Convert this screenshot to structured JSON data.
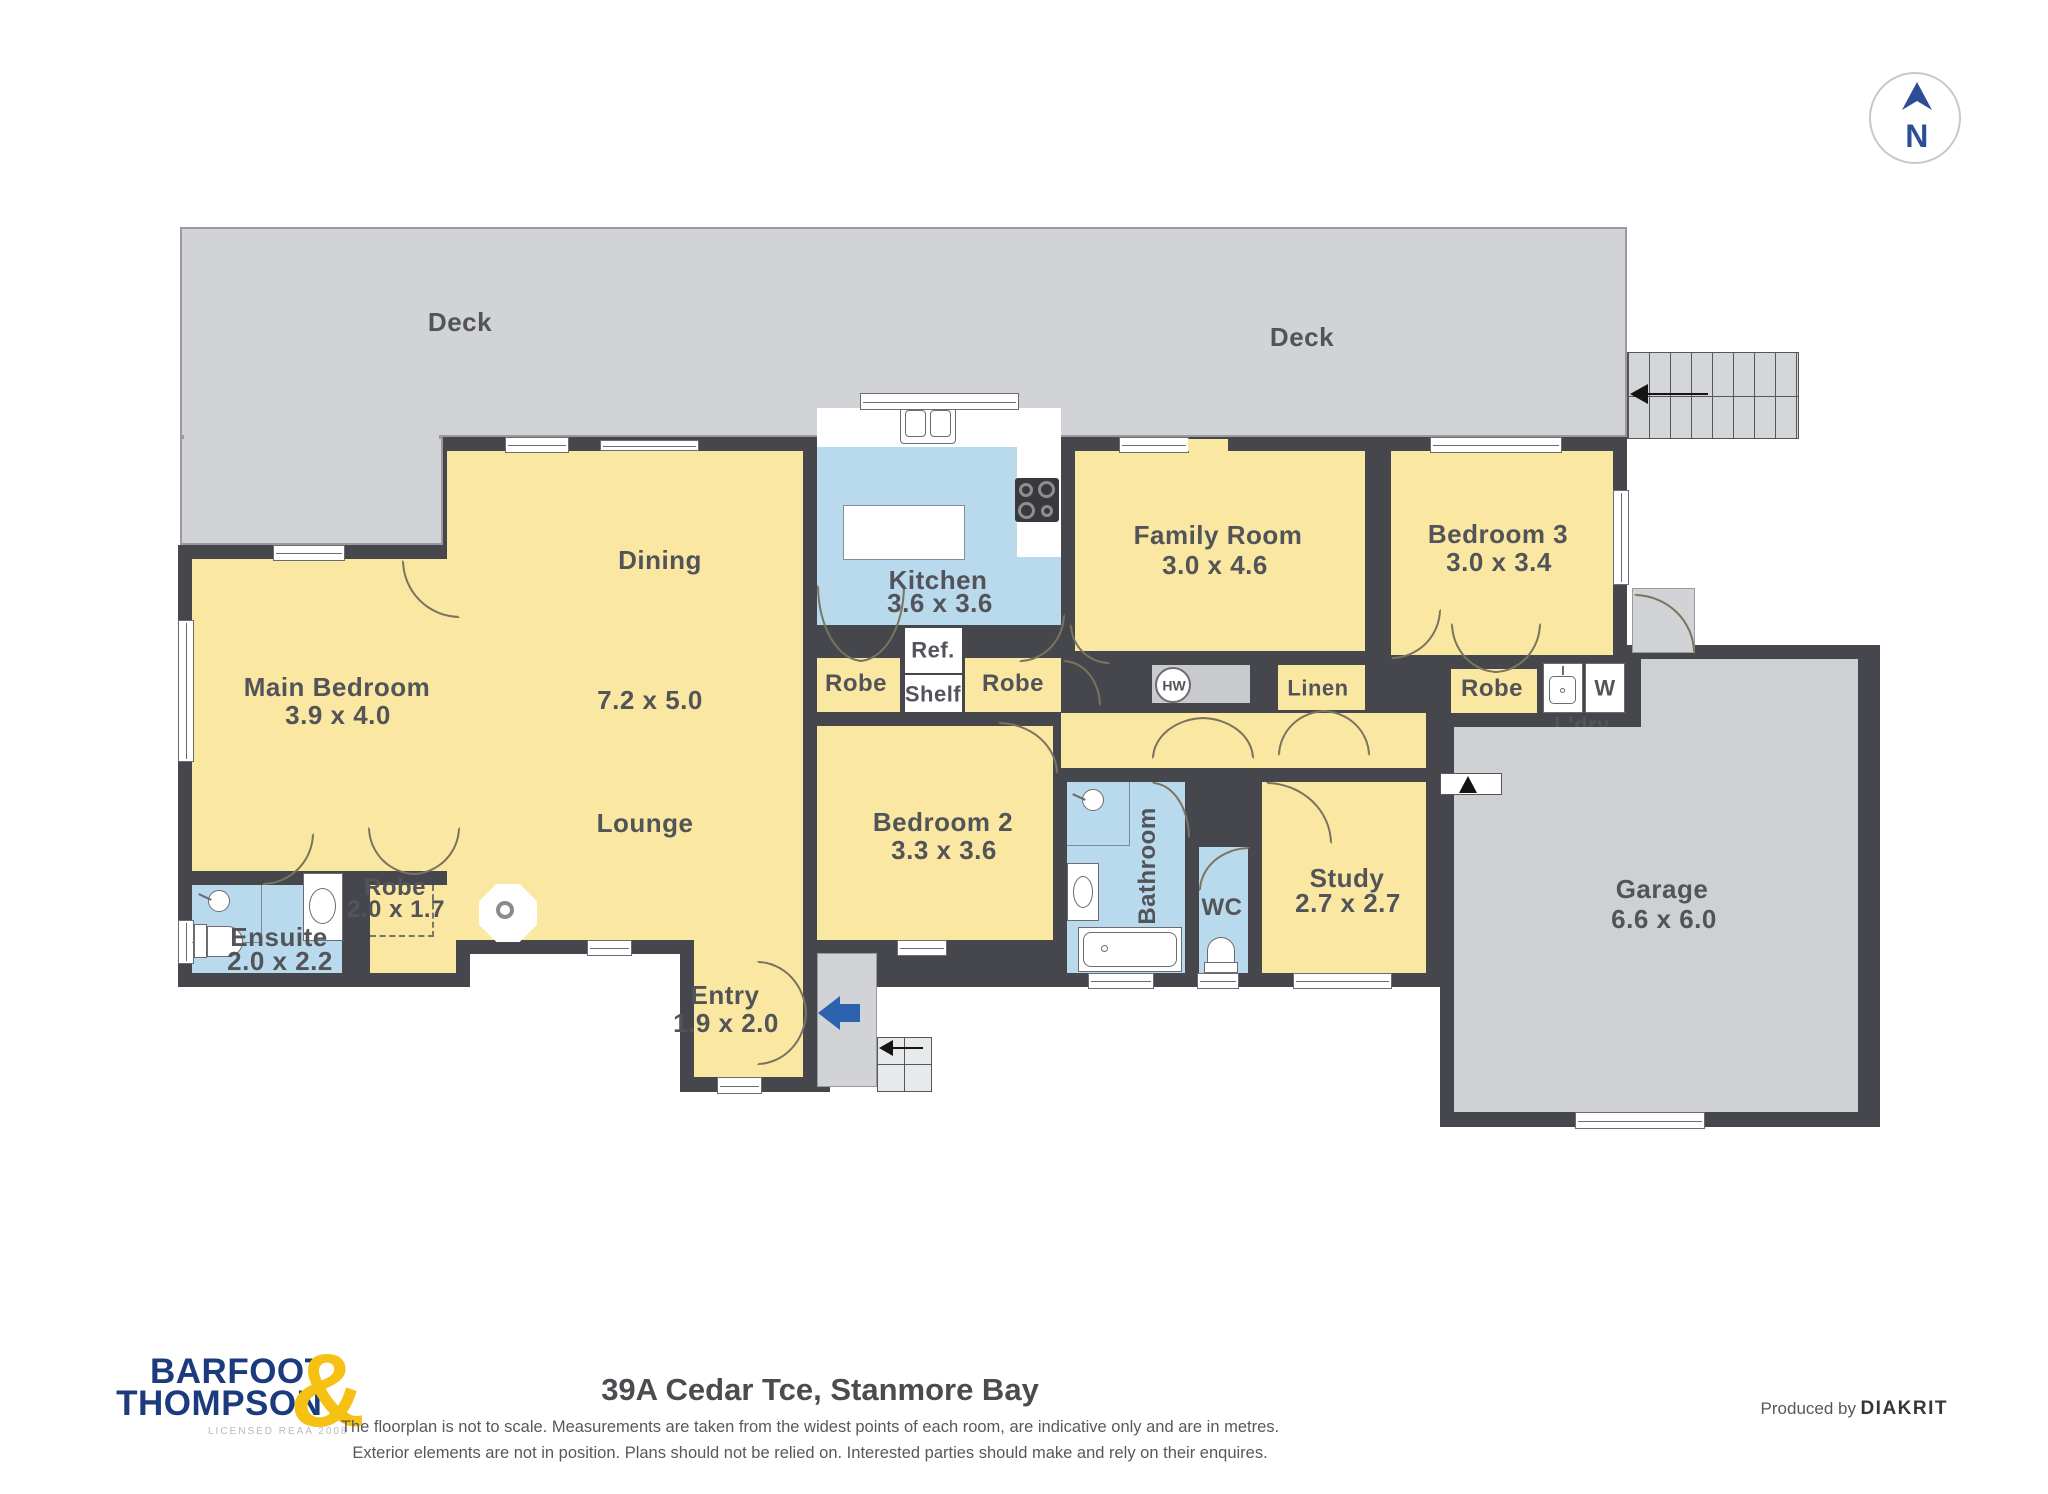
{
  "compass": {
    "label": "N"
  },
  "colors": {
    "wall": "#46474C",
    "room_yellow": "#FAE8A2",
    "wet_blue": "#B9D9EC",
    "deck_gray": "#D2D3D6",
    "garage_gray": "#CFD0D3",
    "logo_navy": "#1C3B7D",
    "logo_gold": "#F5C113",
    "entry_arrow_blue": "#2D62AE"
  },
  "rooms": {
    "deck_left": {
      "name": "Deck"
    },
    "deck_right": {
      "name": "Deck"
    },
    "dining": {
      "name": "Dining",
      "dims": "7.2 x 5.0"
    },
    "lounge": {
      "name": "Lounge"
    },
    "main_bedroom": {
      "name": "Main Bedroom",
      "dims": "3.9 x 4.0"
    },
    "ensuite": {
      "name": "Ensuite",
      "dims": "2.0 x 2.2"
    },
    "robe_main": {
      "name": "Robe",
      "dims": "2.0 x 1.7"
    },
    "kitchen": {
      "name": "Kitchen",
      "dims": "3.6 x 3.6"
    },
    "fridge": {
      "name": "Ref."
    },
    "shelf": {
      "name": "Shelf"
    },
    "robe_kitchen_left": {
      "name": "Robe"
    },
    "robe_kitchen_right": {
      "name": "Robe"
    },
    "family_room": {
      "name": "Family Room",
      "dims": "3.0 x 4.6"
    },
    "hot_water": {
      "name": "HW"
    },
    "linen": {
      "name": "Linen"
    },
    "bedroom3": {
      "name": "Bedroom 3",
      "dims": "3.0 x 3.4"
    },
    "robe_bedroom3": {
      "name": "Robe"
    },
    "laundry": {
      "name": "L'dry",
      "washer": "W"
    },
    "bedroom2": {
      "name": "Bedroom 2",
      "dims": "3.3 x 3.6"
    },
    "bathroom": {
      "name": "Bathroom"
    },
    "wc": {
      "name": "WC"
    },
    "study": {
      "name": "Study",
      "dims": "2.7 x 2.7"
    },
    "garage": {
      "name": "Garage",
      "dims": "6.6 x 6.0"
    },
    "entry": {
      "name": "Entry",
      "dims": "1.9 x 2.0"
    }
  },
  "footer": {
    "logo_line1": "BARFOOT",
    "logo_line2": "THOMPSON",
    "logo_amp": "&",
    "logo_sub": "LICENSED REAA 2008",
    "address": "39A Cedar Tce, Stanmore Bay",
    "disclaimer1": "The floorplan is not to scale. Measurements are taken from the widest points of each room, are indicative only and are in metres.",
    "disclaimer2": "Exterior elements are not in position. Plans should not be relied on. Interested parties should make and rely on their enquires.",
    "produced_prefix": "Produced by",
    "produced_brand": "DIAKRIT"
  }
}
